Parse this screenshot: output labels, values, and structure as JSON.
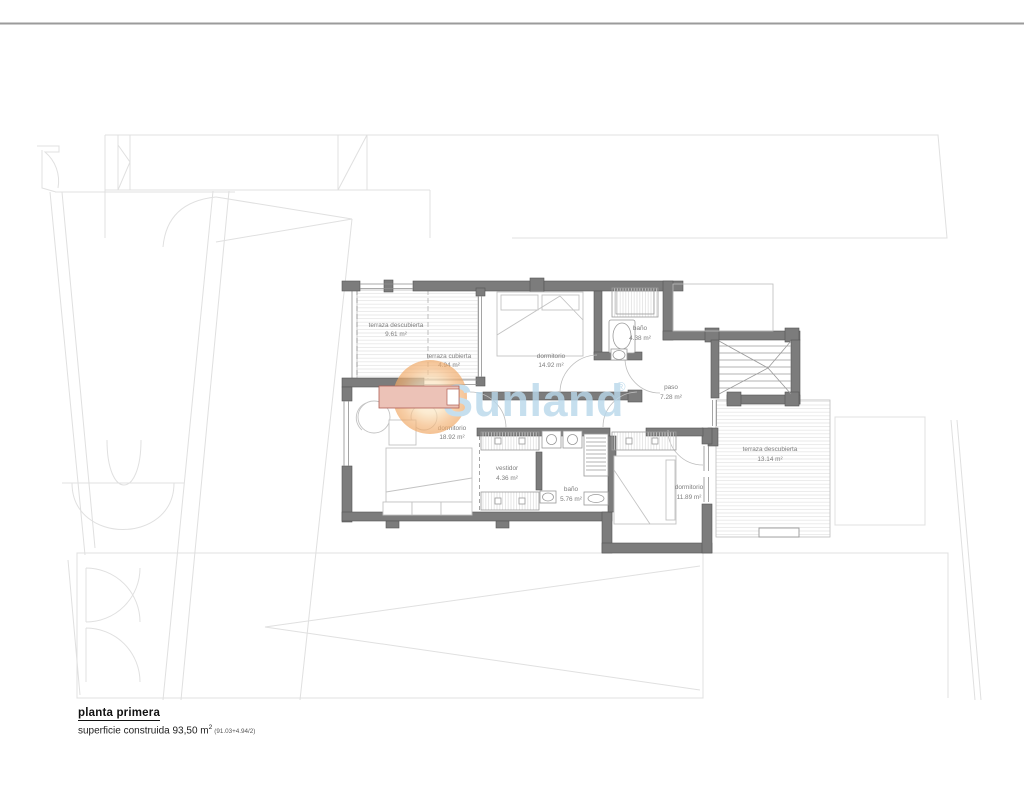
{
  "page": {
    "title": "planta primera",
    "area_label": "superficie construida 93,50 m",
    "area_sup": "2",
    "area_note": "(91.03+4.94/2)"
  },
  "watermark": {
    "brand": "Sunland",
    "registered": "®",
    "sun_color": "#f0a763",
    "text_color": "#b9d8eb"
  },
  "rooms": [
    {
      "name": "terraza descubierta",
      "area": "9.61 m²"
    },
    {
      "name": "terraza cubierta",
      "area": "4.94 m²"
    },
    {
      "name": "dormitorio",
      "area": "14.92 m²"
    },
    {
      "name": "baño",
      "area": "4.38 m²"
    },
    {
      "name": "paso",
      "area": "7.28 m²"
    },
    {
      "name": "dormitorio",
      "area": "18.92 m²"
    },
    {
      "name": "vestidor",
      "area": "4.36 m²"
    },
    {
      "name": "baño",
      "area": "5.76 m²"
    },
    {
      "name": "dormitorio",
      "area": "11.89 m²"
    },
    {
      "name": "terraza descubierta",
      "area": "13.14 m²"
    }
  ]
}
